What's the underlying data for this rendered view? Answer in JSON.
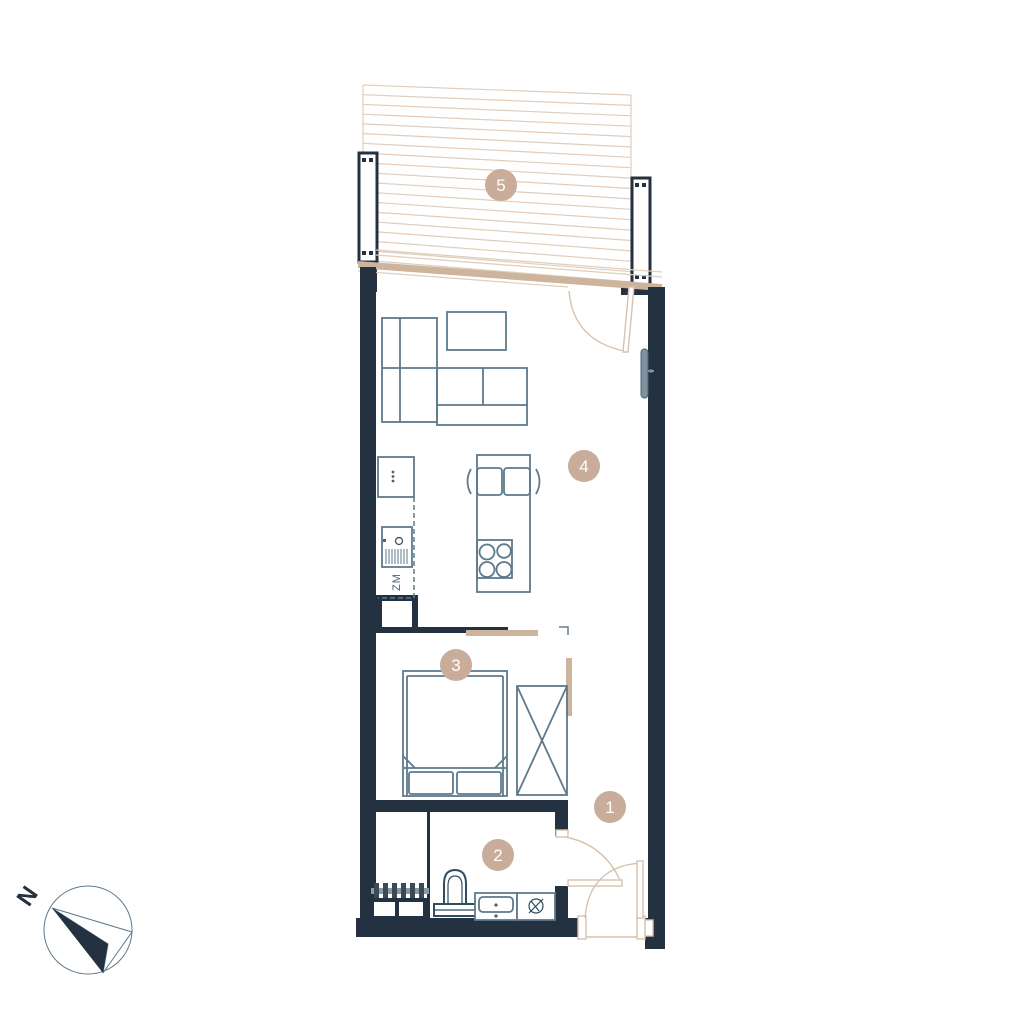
{
  "plan": {
    "rooms": [
      {
        "number": "1",
        "name": "hall"
      },
      {
        "number": "2",
        "name": "bathroom"
      },
      {
        "number": "3",
        "name": "bedroom"
      },
      {
        "number": "4",
        "name": "living-room-kitchen"
      },
      {
        "number": "5",
        "name": "balcony"
      }
    ],
    "kitchen": {
      "dishwasher_label": "ZM"
    },
    "compass": {
      "north_label": "N"
    },
    "colors": {
      "wall": "#233140",
      "furniture_line": "#5d7a8c",
      "fixture_line": "#2f4d61",
      "balcony_hatch": "#e0cdbb",
      "window_band": "#cdb49c",
      "door_arc": "#d8c2ac",
      "room_label_circle": "#c9ac99",
      "room_label_text": "#ffffff",
      "radiator": "#7e939f"
    }
  }
}
